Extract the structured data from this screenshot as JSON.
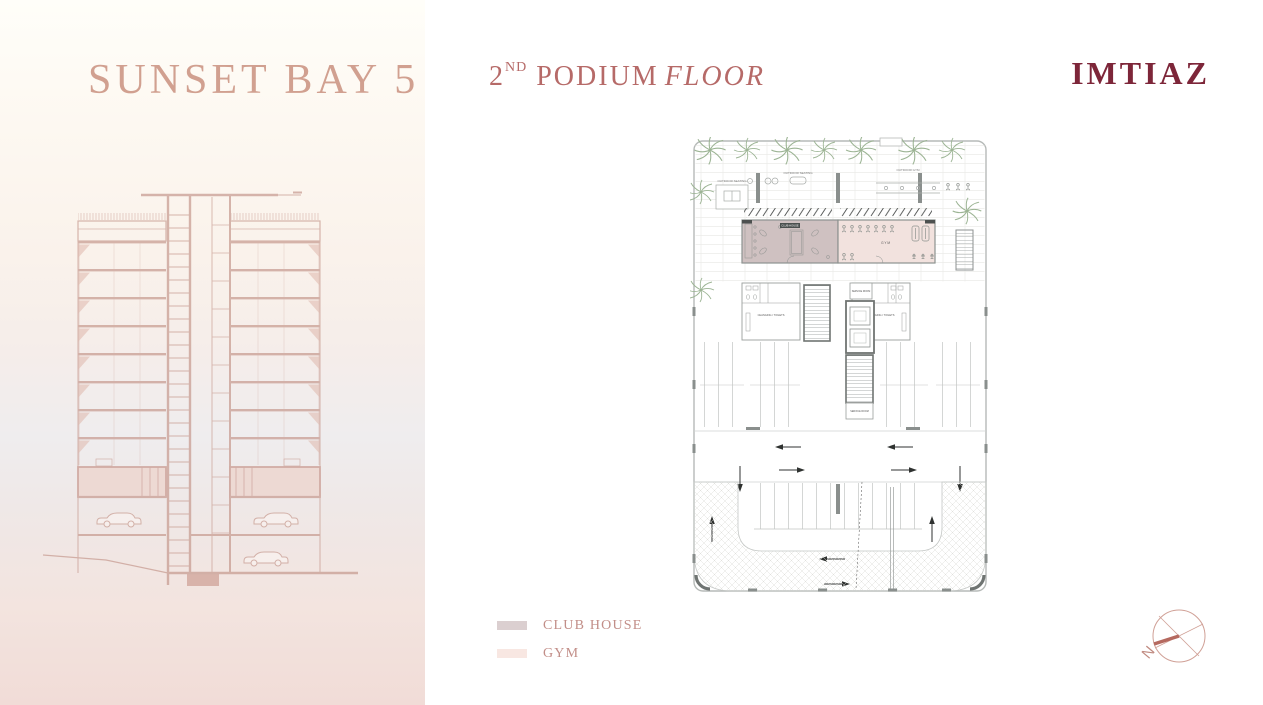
{
  "page": {
    "background": "#ffffff"
  },
  "left_panel": {
    "title": "SUNSET BAY 5",
    "title_color": "#d1a090"
  },
  "header": {
    "floor_number": "2",
    "floor_ordinal": "ND",
    "floor_word": "PODIUM",
    "floor_italic": "FLOOR",
    "color": "#b66a68"
  },
  "brand": {
    "name": "IMTIAZ",
    "color": "#7d2639"
  },
  "floor_plan": {
    "labels": {
      "club_house": "CLUB HOUSE",
      "gym": "GYM",
      "changing_toilets": "CHANGING / TOILETS",
      "service_room": "SERVICE ROOM",
      "outdoor_seating": "OUTDOOR SEATING",
      "outdoor_gym": "OUTDOOR GYM"
    },
    "colors": {
      "club_house_fill": "#cfc1c1",
      "gym_fill": "#f2e2de",
      "wall": "#8d918f",
      "palm": "#9cb494"
    }
  },
  "legend": {
    "items": [
      {
        "label": "CLUB HOUSE",
        "color": "#dbcfd0"
      },
      {
        "label": "GYM",
        "color": "#f8e7e2"
      }
    ]
  },
  "compass": {
    "north_label": "N"
  }
}
